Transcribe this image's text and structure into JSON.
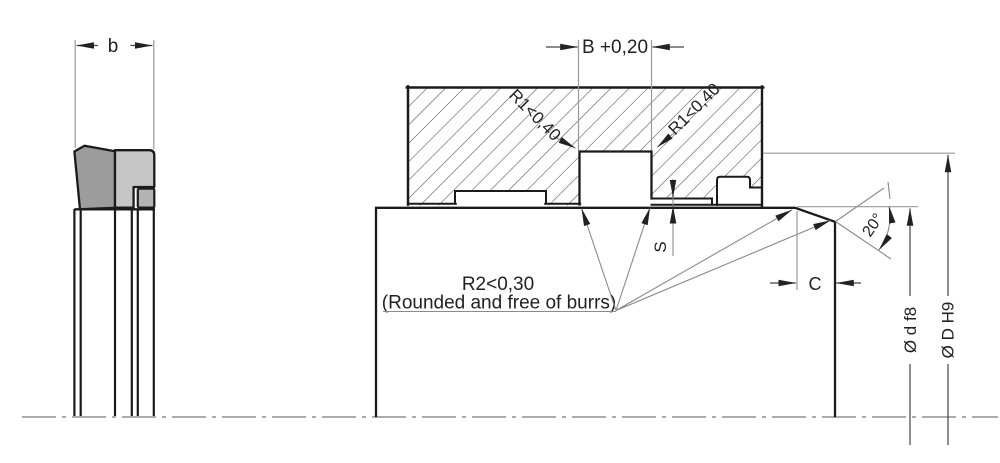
{
  "drawing": {
    "type": "technical-seal-groove-drawing",
    "labels": {
      "seal_width": "b",
      "groove_width": "B +0,20",
      "radius_left": "R1<0,40",
      "radius_right": "R1<0,40",
      "step_depth": "S",
      "edge_note_line1": "R2<0,30",
      "edge_note_line2": "(Rounded and free of burrs)",
      "chamfer_length": "C",
      "chamfer_angle": "20°",
      "rod_diameter": "Ø d f8",
      "bore_diameter": "Ø D H9"
    },
    "colors": {
      "outline": "#1b1b1b",
      "dimension_lines": "#999999",
      "hatch": "#4d4d4d",
      "seal_body_dark": "#9c9c9c",
      "seal_body_light": "#c6c6c6",
      "seal_insert": "#b3b3b3",
      "background": "#ffffff"
    }
  }
}
